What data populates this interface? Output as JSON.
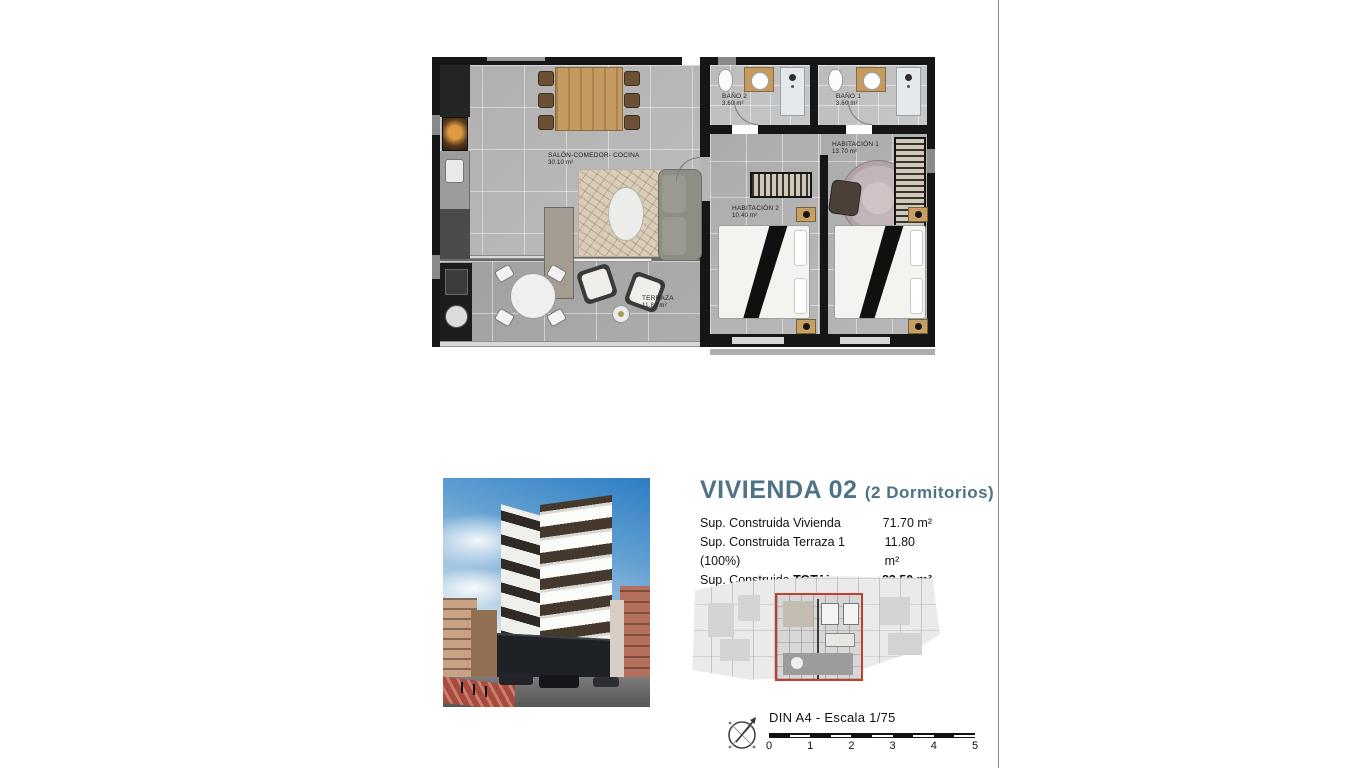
{
  "sheet": {
    "title": "VIVIENDA 02",
    "title_suffix": "(2 Dormitorios)",
    "specs": [
      {
        "label": "Sup. Construida Vivienda",
        "value": "71.70 m²"
      },
      {
        "label": "Sup. Construida Terraza 1 (100%)",
        "value": "11.80 m²"
      },
      {
        "label": "Sup. Construida ",
        "label_bold": "TOTAL",
        "value": "83.50 m²"
      }
    ],
    "floorplan": {
      "rooms": [
        {
          "name": "BAÑO 2",
          "area": "3.60 m²"
        },
        {
          "name": "BAÑO 1",
          "area": "3.60 m²"
        },
        {
          "name": "HABITACIÓN 1",
          "area": "13.70 m²"
        },
        {
          "name": "HABITACIÓN 2",
          "area": "10.40 m²"
        },
        {
          "name": "SALÓN-COMEDOR- COCINA",
          "area": "30.10 m²"
        },
        {
          "name": "TERRAZA",
          "area": "11.80 m²"
        }
      ]
    },
    "footer": {
      "scale_label": "DIN A4 - Escala 1/75",
      "ticks": [
        "0",
        "1",
        "2",
        "3",
        "4",
        "5"
      ]
    },
    "colors": {
      "accent": "#4e7386",
      "keyplan_highlight": "#c43e30"
    }
  }
}
